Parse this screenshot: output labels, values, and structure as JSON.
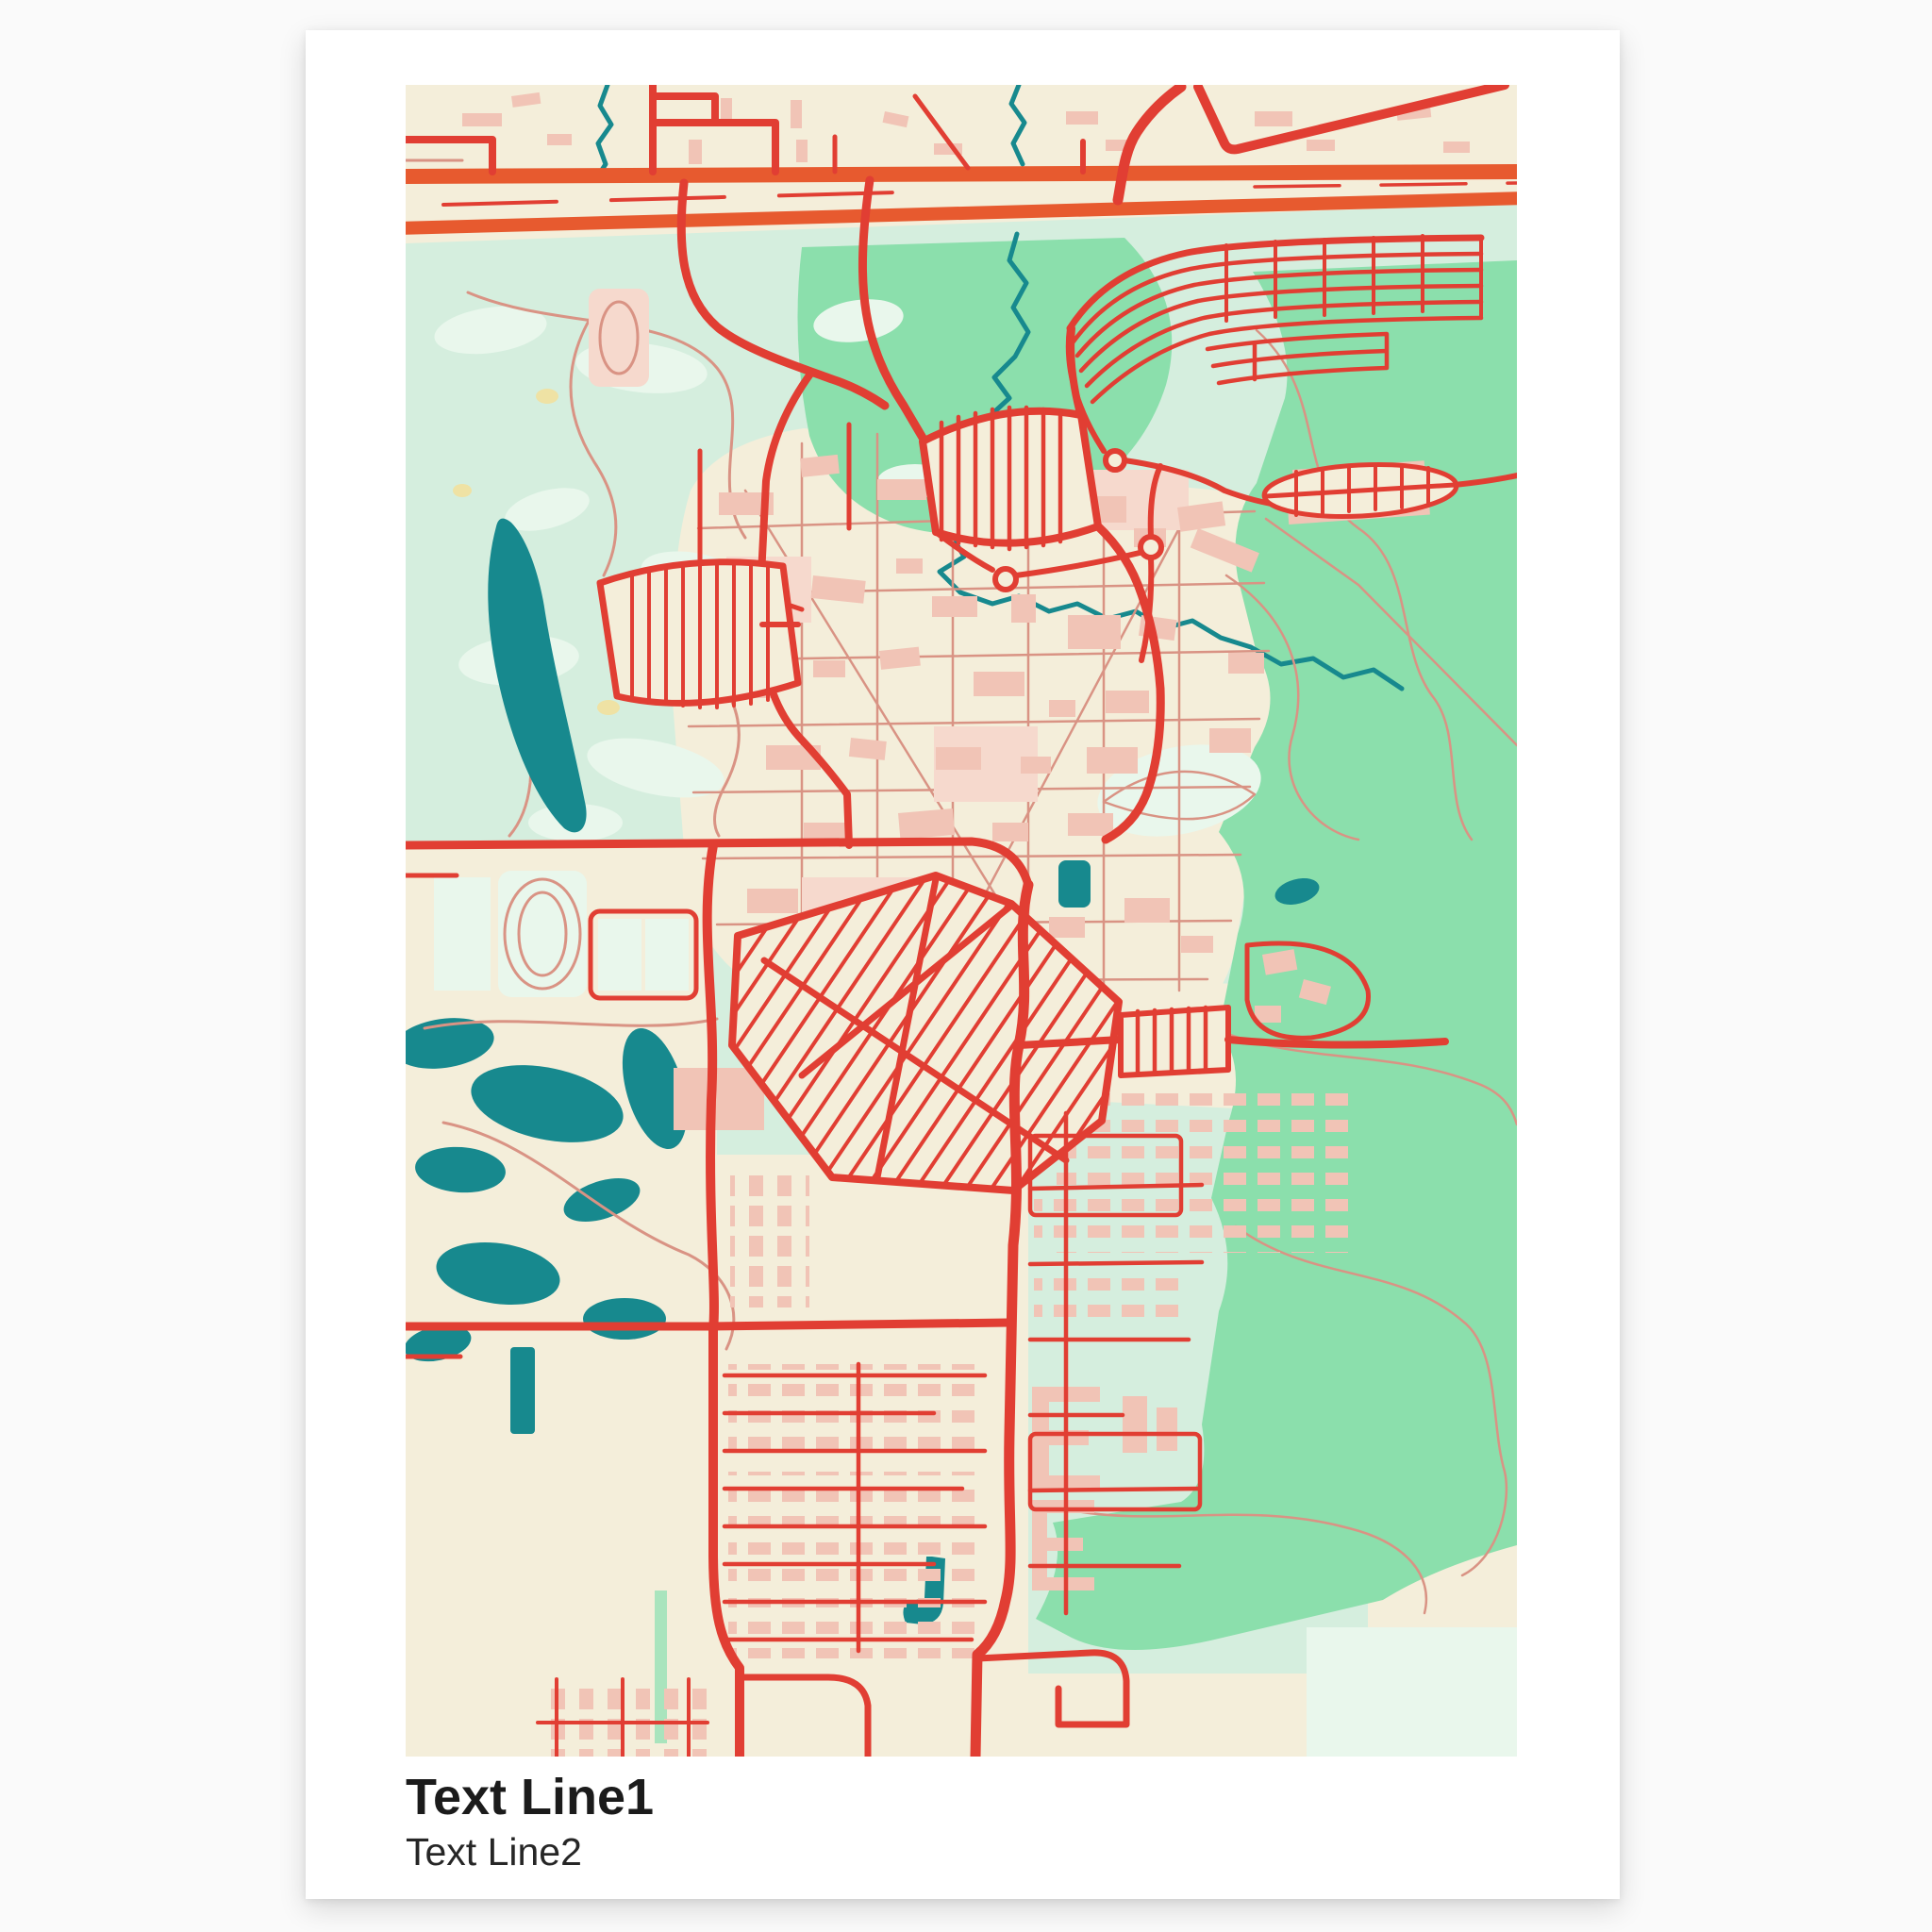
{
  "poster": {
    "title": "Text Line1",
    "subtitle": "Text Line2"
  },
  "map": {
    "style": "pastel-city-map",
    "features": [
      "highway",
      "main-roads",
      "residential-grids",
      "river",
      "lakes",
      "golf-course",
      "parks",
      "campus-buildings",
      "stadium-track"
    ]
  },
  "palette": {
    "pageBg": "#fafafa",
    "paper": "#ffffff",
    "ink": "#1b1b1b",
    "inkSoft": "#262626",
    "cream": "#f4eeda",
    "mint": "#d5eede",
    "mintLight": "#e9f7ec",
    "green": "#8bdfac",
    "greenSoft": "#a9e4bd",
    "teal": "#17898e",
    "orange": "#e75a2f",
    "red": "#e13e33",
    "salmon": "#d99384",
    "pink": "#f1c4b6",
    "pinkLight": "#f6d9cd",
    "sand": "#efe2a4"
  }
}
